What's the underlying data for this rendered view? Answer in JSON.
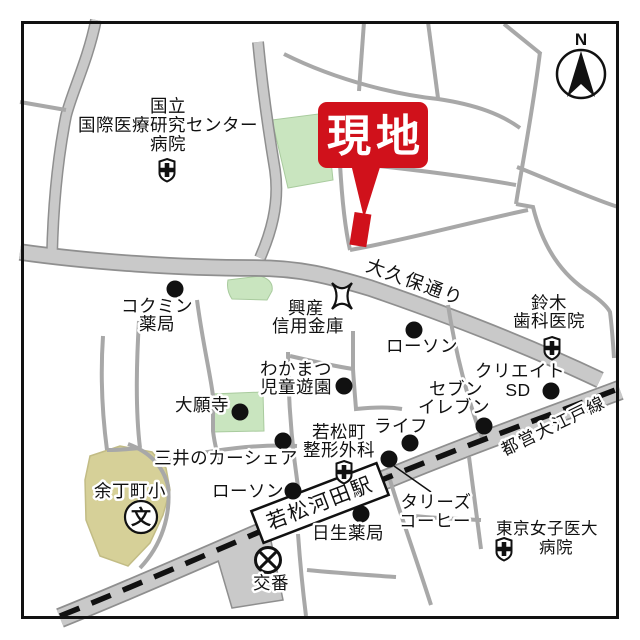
{
  "map": {
    "site": {
      "label": "現地"
    },
    "compass": {
      "label": "N"
    },
    "roads": {
      "okubo": "大久保通り",
      "oedo": "都営大江戸線"
    },
    "station": {
      "label": "若松河田駅"
    },
    "pois": {
      "kokuritsu_hospital": {
        "lines": [
          "国立",
          "国際医療研究センター",
          "病院"
        ]
      },
      "kokumin_pharmacy": {
        "lines": [
          "コクミン",
          "薬局"
        ]
      },
      "kosan_shinkin": {
        "lines": [
          "興産",
          "信用金庫"
        ]
      },
      "suzuki_dental": {
        "lines": [
          "鈴木",
          "歯科医院"
        ]
      },
      "lawson_north": {
        "label": "ローソン"
      },
      "wakamatsu_playground": {
        "lines": [
          "わかまつ",
          "児童遊園"
        ]
      },
      "create_sd": {
        "lines": [
          "クリエイト",
          "SD"
        ]
      },
      "seven_eleven": {
        "lines": [
          "セブン",
          "イレブン"
        ]
      },
      "daiganji": {
        "label": "大願寺"
      },
      "life": {
        "label": "ライフ"
      },
      "wakamatsucho_seikei": {
        "lines": [
          "若松町",
          "整形外科"
        ]
      },
      "mitsui_carshare": {
        "label": "三井のカーシェア"
      },
      "yochomachi_elementary": {
        "label": "余丁町小",
        "symbol": "文"
      },
      "lawson_south": {
        "label": "ローソン"
      },
      "tullys_coffee": {
        "lines": [
          "タリーズ",
          "コーヒー"
        ]
      },
      "nissei_pharmacy": {
        "label": "日生薬局"
      },
      "tokyo_womens_hospital": {
        "lines": [
          "東京女子医大",
          "病院"
        ]
      },
      "koban": {
        "label": "交番"
      }
    },
    "colors": {
      "site_red": "#d0111b",
      "road_fill": "#c9c9c9",
      "road_casing": "#8f8f8f",
      "minor_street": "#a8a8a8",
      "park_green": "#c9e5bf",
      "school_tan": "#d6d098",
      "railway_black": "#111111"
    }
  }
}
